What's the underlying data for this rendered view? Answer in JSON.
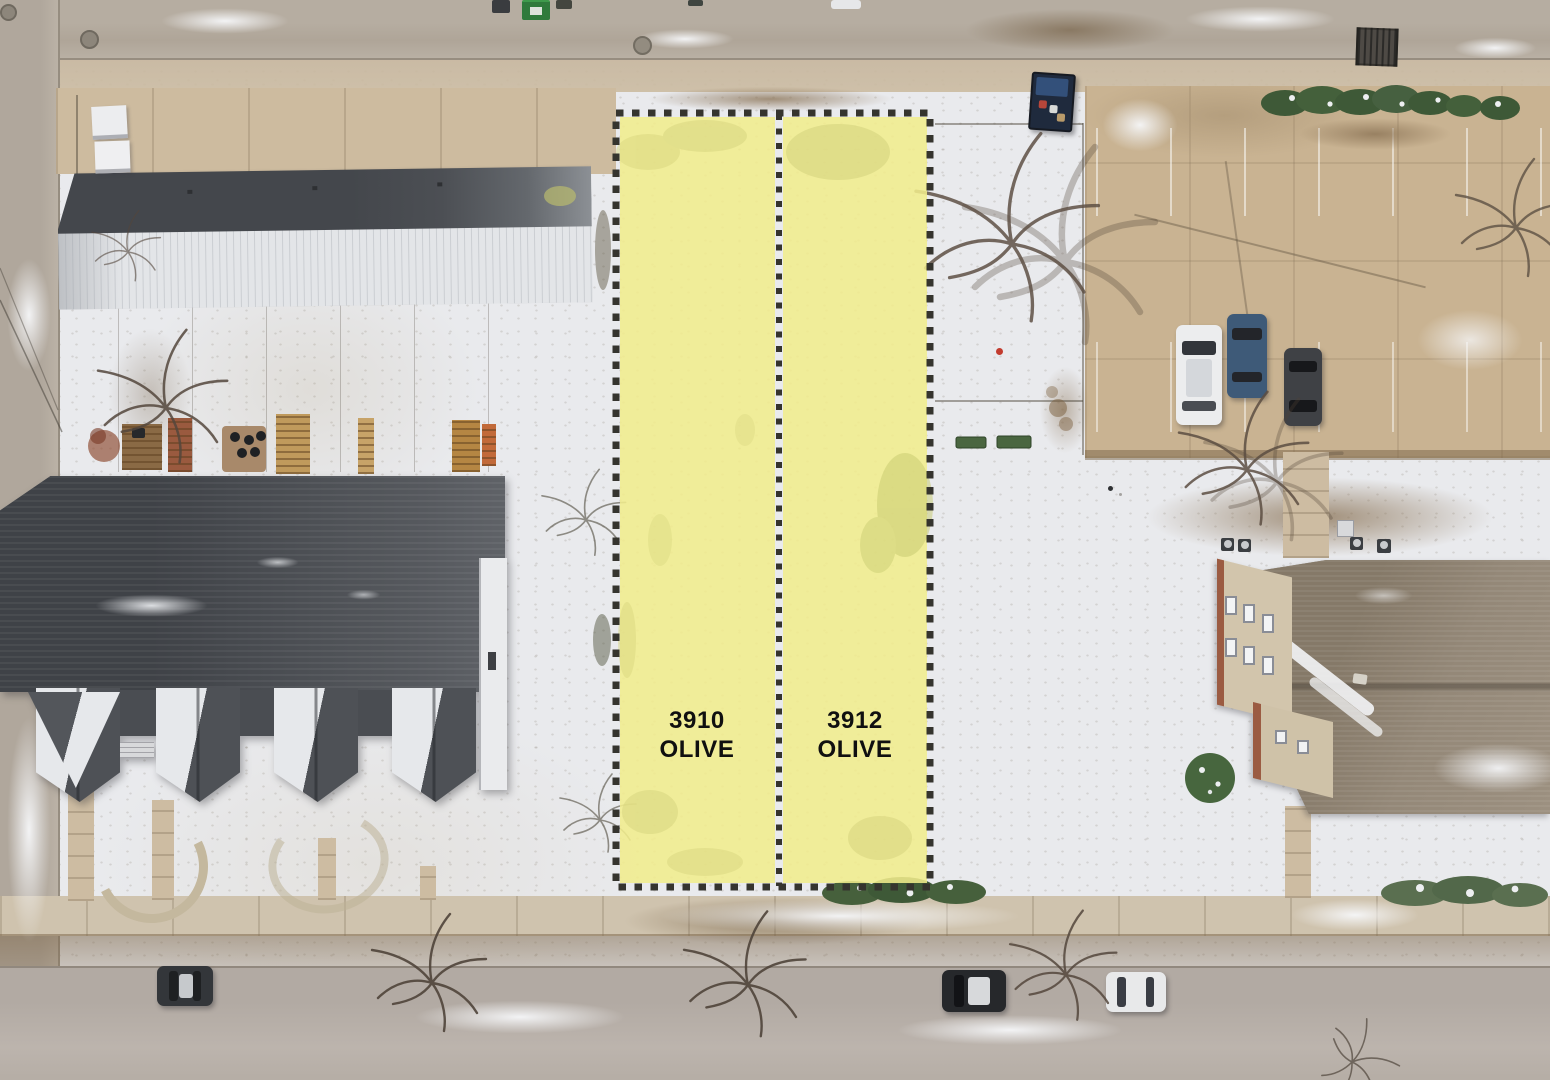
{
  "overlay": {
    "lots": [
      {
        "address_line1": "3910",
        "address_line2": "OLIVE"
      },
      {
        "address_line1": "3912",
        "address_line2": "OLIVE"
      }
    ],
    "highlight_fill": "#F1ED8C",
    "boundary_color": "#35342E",
    "label_color": "#101010"
  },
  "palette": {
    "snow": "#E9EAED",
    "pavement_tan": "#C9B392",
    "street_gray": "#B3AAA0",
    "roof_dark_gray": "#4B4E53",
    "roof_brown": "#8F8375",
    "wood_deck": "#B08048",
    "evergreen": "#3F5B38"
  }
}
